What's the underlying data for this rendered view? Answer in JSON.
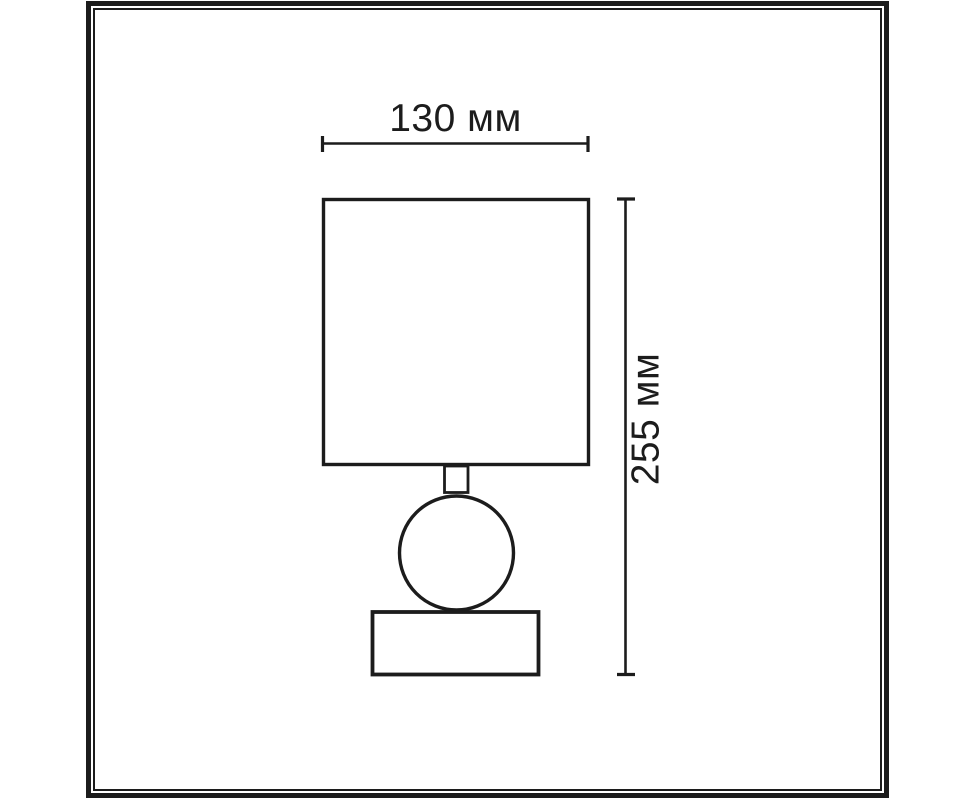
{
  "diagram": {
    "dimensions": {
      "width": {
        "value": 130,
        "unit": "мм",
        "label": "130 мм"
      },
      "height": {
        "value": 255,
        "unit": "мм",
        "label": "255 мм"
      }
    },
    "colors": {
      "line": "#1c1c1c",
      "background": "#ffffff"
    }
  }
}
